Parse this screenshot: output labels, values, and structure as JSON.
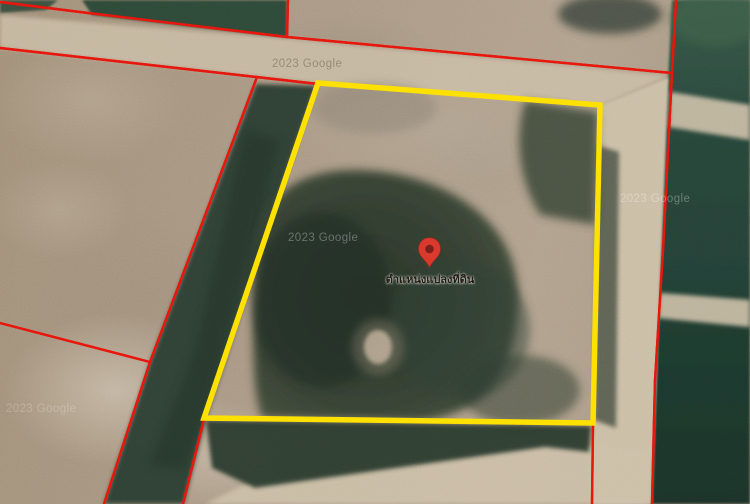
{
  "map": {
    "marker_label": "ตำแหน่งแปลงที่ดิน",
    "watermark_text": "2023 Google"
  },
  "colors": {
    "plot-outline": "#ffe100",
    "parcel-line": "#e8170d",
    "parcel-line-core": "#f4b0a4",
    "marker": "#da392e",
    "marker-dark": "#a8241c",
    "marker-hole": "#7e201a",
    "label-text": "#241d12",
    "road": "#cdc0a8",
    "dirt-base": "#a99880",
    "vegetation": "#2c3e31",
    "field-green-top": "#355746",
    "field-green-bottom": "#1b3329",
    "watermark-light": "rgba(255,255,255,0.30)",
    "watermark-dark": "rgba(80,72,60,0.40)"
  }
}
